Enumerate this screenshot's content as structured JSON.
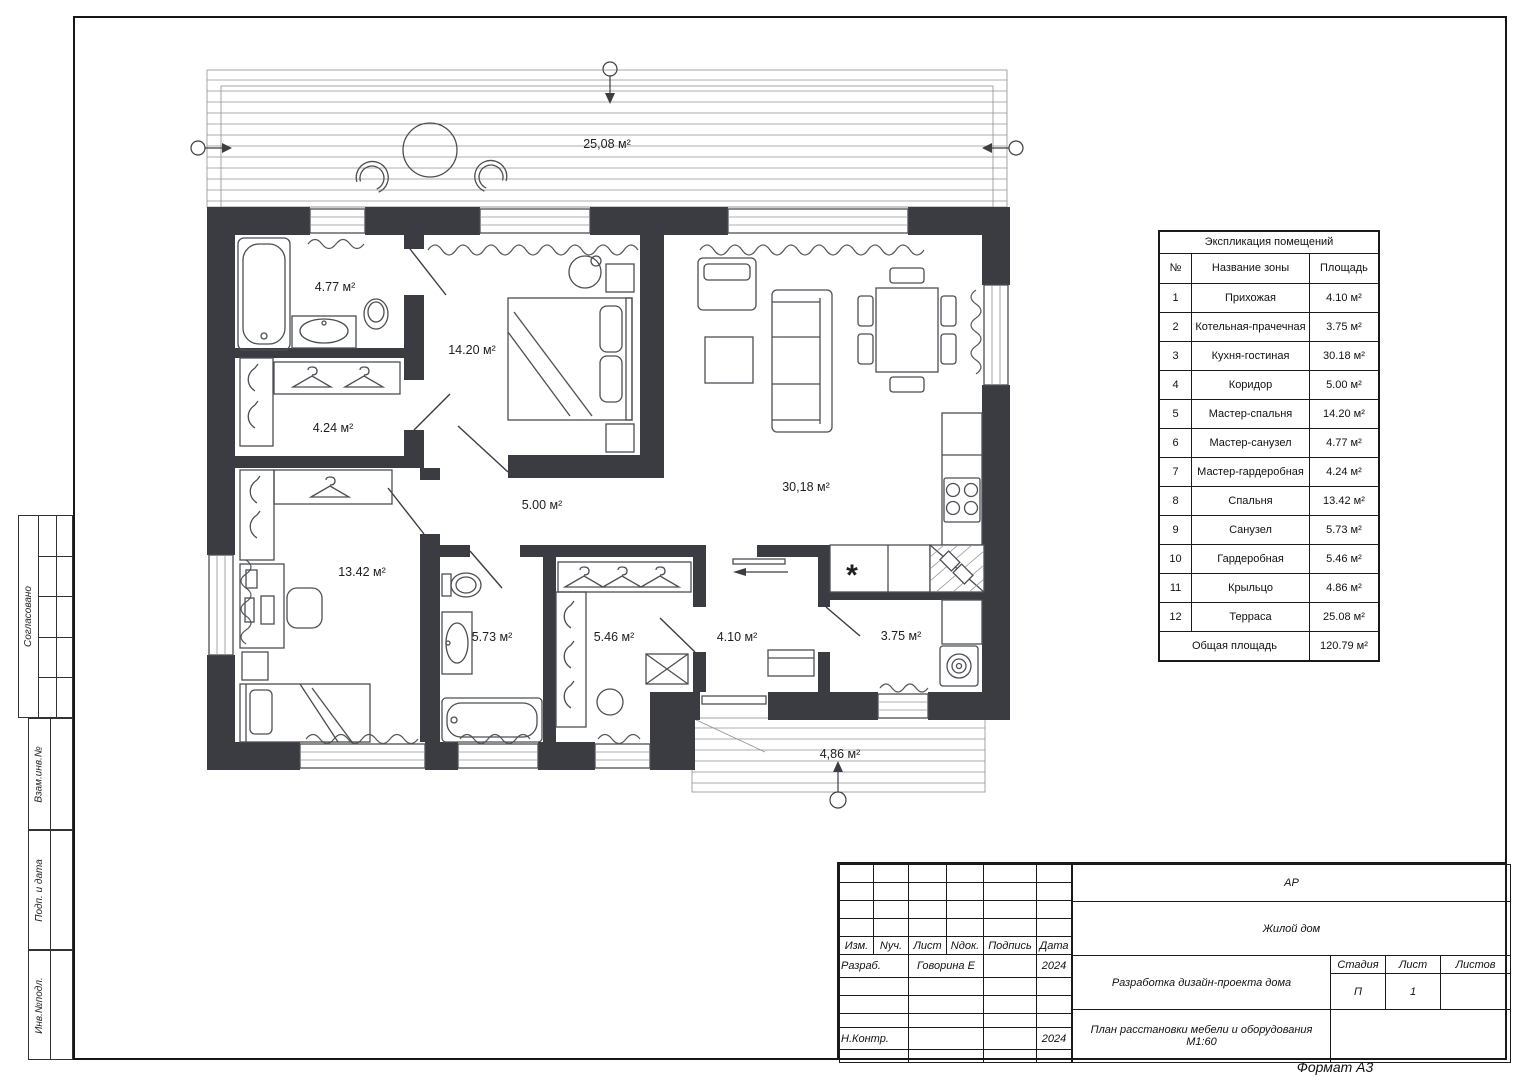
{
  "frame": {
    "format_label": "Формат А3"
  },
  "side_panel": {
    "labels": [
      "Согласовано",
      "Взам.инв.№",
      "Подп. и дата",
      "Инв.№подл."
    ]
  },
  "plan": {
    "labels": {
      "terrace": "25,08 м²",
      "master_bath": "4.77 м²",
      "master_bedroom": "14.20 м²",
      "master_wardrobe": "4.24 м²",
      "corridor": "5.00 м²",
      "living": "30,18 м²",
      "bedroom": "13.42 м²",
      "bathroom": "5.73 м²",
      "wardrobe": "5.46 м²",
      "hallway": "4.10 м²",
      "boiler": "3.75 м²",
      "porch": "4,86 м²"
    },
    "kitchen_symbol": "*"
  },
  "explication": {
    "title": "Экспликация помещений",
    "columns": [
      "№",
      "Название зоны",
      "Площадь"
    ],
    "rows": [
      {
        "num": "1",
        "name": "Прихожая",
        "area": "4.10 м²"
      },
      {
        "num": "2",
        "name": "Котельная-прачечная",
        "area": "3.75 м²"
      },
      {
        "num": "3",
        "name": "Кухня-гостиная",
        "area": "30.18 м²"
      },
      {
        "num": "4",
        "name": "Коридор",
        "area": "5.00 м²"
      },
      {
        "num": "5",
        "name": "Мастер-спальня",
        "area": "14.20 м²"
      },
      {
        "num": "6",
        "name": "Мастер-санузел",
        "area": "4.77 м²"
      },
      {
        "num": "7",
        "name": "Мастер-гардеробная",
        "area": "4.24 м²"
      },
      {
        "num": "8",
        "name": "Спальня",
        "area": "13.42 м²"
      },
      {
        "num": "9",
        "name": "Санузел",
        "area": "5.73 м²"
      },
      {
        "num": "10",
        "name": "Гардеробная",
        "area": "5.46 м²"
      },
      {
        "num": "11",
        "name": "Крыльцо",
        "area": "4.86 м²"
      },
      {
        "num": "12",
        "name": "Терраса",
        "area": "25.08 м²"
      }
    ],
    "total_label": "Общая площадь",
    "total_area": "120.79 м²"
  },
  "title_block": {
    "revision_headers": [
      "Изм.",
      "Nуч.",
      "Лист",
      "Nдок.",
      "Подпись",
      "Дата"
    ],
    "sig_rows": [
      {
        "role": "Разраб.",
        "name": "Говорина Е",
        "sign": "",
        "date": "2024"
      },
      {
        "role": "",
        "name": "",
        "sign": "",
        "date": ""
      },
      {
        "role": "",
        "name": "",
        "sign": "",
        "date": ""
      },
      {
        "role": "",
        "name": "",
        "sign": "",
        "date": ""
      },
      {
        "role": "Н.Контр.",
        "name": "",
        "sign": "",
        "date": "2024"
      },
      {
        "role": "",
        "name": "",
        "sign": "",
        "date": ""
      }
    ],
    "code": "АР",
    "object_name": "Жилой дом",
    "project_name": "Разработка дизайн-проекта дома",
    "stage_label": "Стадия",
    "sheet_label": "Лист",
    "sheets_label": "Листов",
    "stage": "П",
    "sheet": "1",
    "sheets": "",
    "drawing_title": "План расстановки мебели и оборудования",
    "scale": "М1:60"
  }
}
